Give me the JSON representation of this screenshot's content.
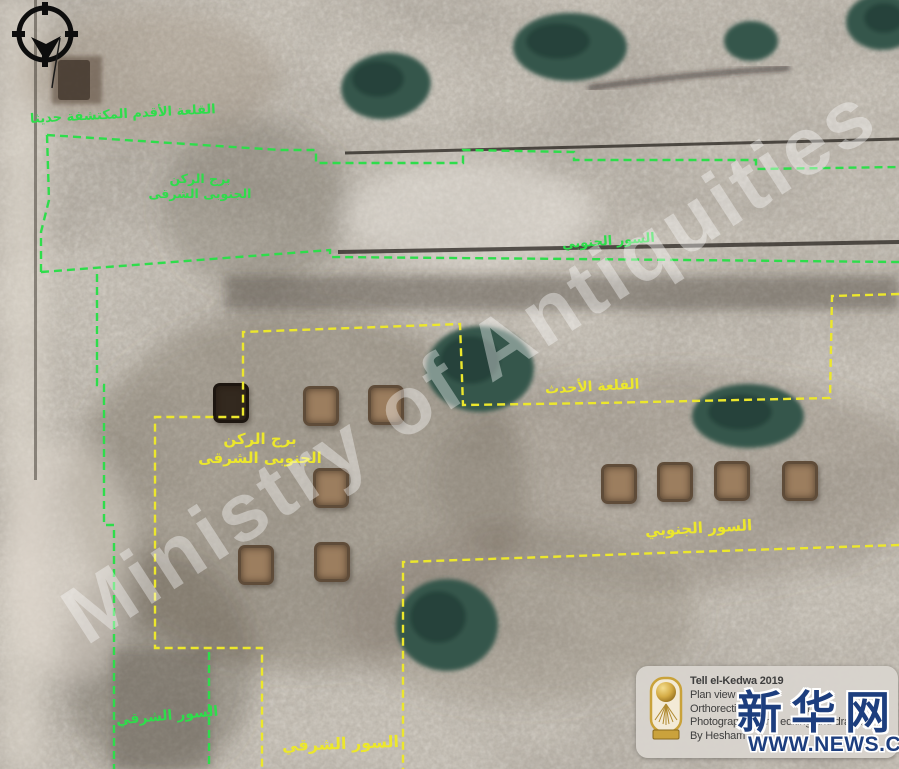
{
  "title": "Tell el-Kedwa 2019 excavation plan (annotated orthophoto)",
  "colors": {
    "old_fortress_green": "#2edd4b",
    "new_fortress_yellow": "#ece72c",
    "xinhua_navy": "#1d3e7e",
    "info_box_bg": "#d9d5d0",
    "info_text": "#3e3e3e",
    "logo_gold": "#c9a23a",
    "watermark_white": "#ffffff"
  },
  "compass": {
    "icon": "north-arrow"
  },
  "watermark": {
    "text": "Ministry of Antiquities"
  },
  "labels": {
    "old_fortress": {
      "text": "القلعة الأقدم المكتشفة حديثا"
    },
    "old_se_tower": {
      "line1": "برج الركن",
      "line2": "الجنوبى الشرقى"
    },
    "old_south_wall": {
      "text": "السور الجنوبي"
    },
    "old_east_wall": {
      "text": "السور الشرقي"
    },
    "new_fortress": {
      "text": "القلعة الأحدث"
    },
    "new_se_tower": {
      "line1": "برج الركن",
      "line2": "الجنوبى الشرقى"
    },
    "new_south_wall": {
      "text": "السور الجنوبي"
    },
    "new_east_wall": {
      "text": "السور الشرقي"
    }
  },
  "info_box": {
    "line1": "Tell el-Kedwa 2019",
    "line2": "Plan view",
    "line3": "Orthorectified",
    "line3_frag_a": "fr",
    "line3_frag_b": "gr",
    "line4": "Photographed and editing and drawing",
    "line5": "By Hesham"
  },
  "news_logo": {
    "wordmark": "新华网",
    "url": "WWW.NEWS.CN"
  }
}
